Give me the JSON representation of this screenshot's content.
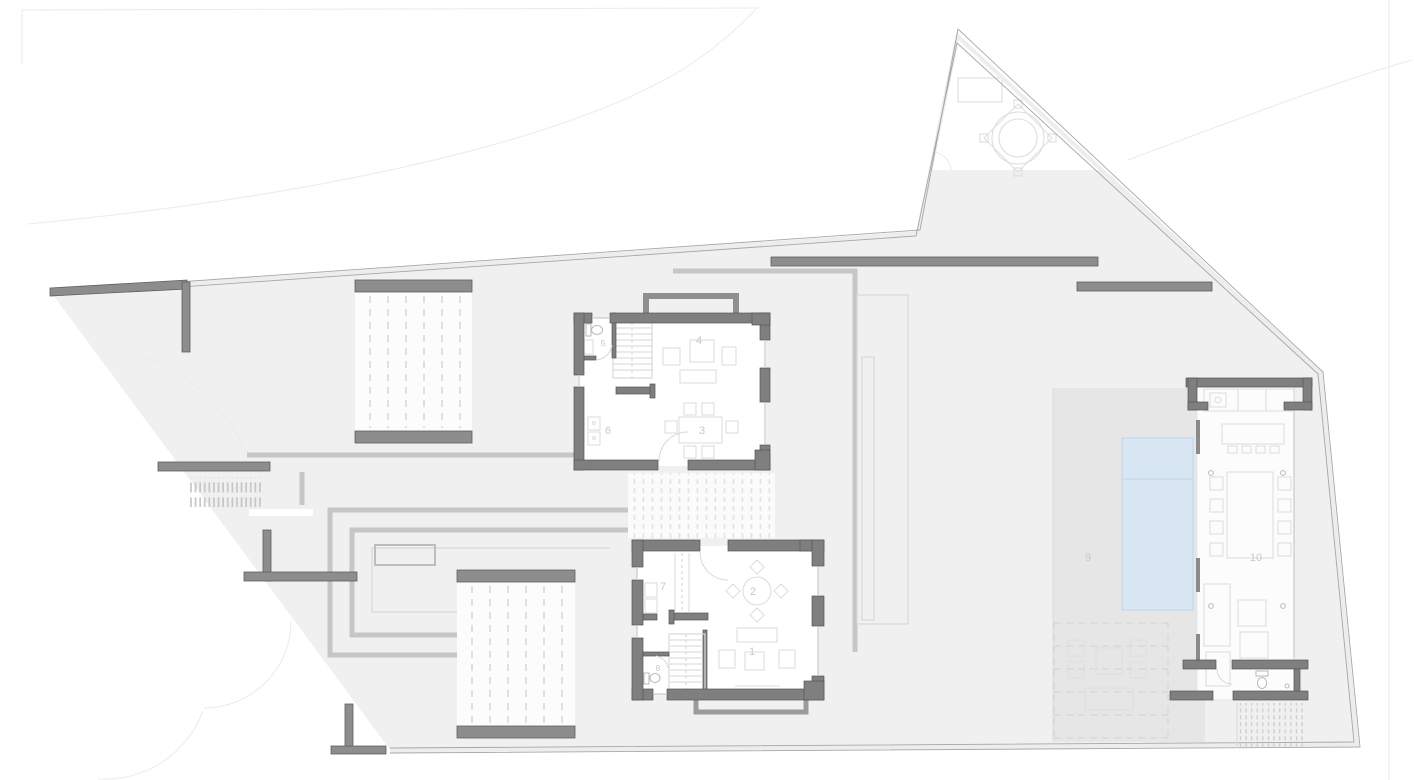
{
  "plan": {
    "type": "architectural-site-floor-plan",
    "rooms": [
      {
        "label": "1"
      },
      {
        "label": "2"
      },
      {
        "label": "3"
      },
      {
        "label": "4"
      },
      {
        "label": "5"
      },
      {
        "label": "6"
      },
      {
        "label": "7"
      },
      {
        "label": "8"
      },
      {
        "label": "9"
      },
      {
        "label": "10"
      }
    ]
  },
  "colors": {
    "background": "#ffffff",
    "terrain": "#f0f0f1",
    "terrace": "#e6e6e7",
    "wall_fill": "#7f7f7f",
    "wall_stroke": "#555555",
    "site_wall": "#8d8d8d",
    "path": "#c6c6c6",
    "furniture": "#dedede",
    "fixture": "#b9b9b9",
    "boundary": "#a6a6a6",
    "pool_fill": "#d8e6f4",
    "pool_stroke": "#c0d4e7",
    "deck_dot": "#e2e2e2",
    "label": "#c8c8c8",
    "faint": "#ececec"
  }
}
